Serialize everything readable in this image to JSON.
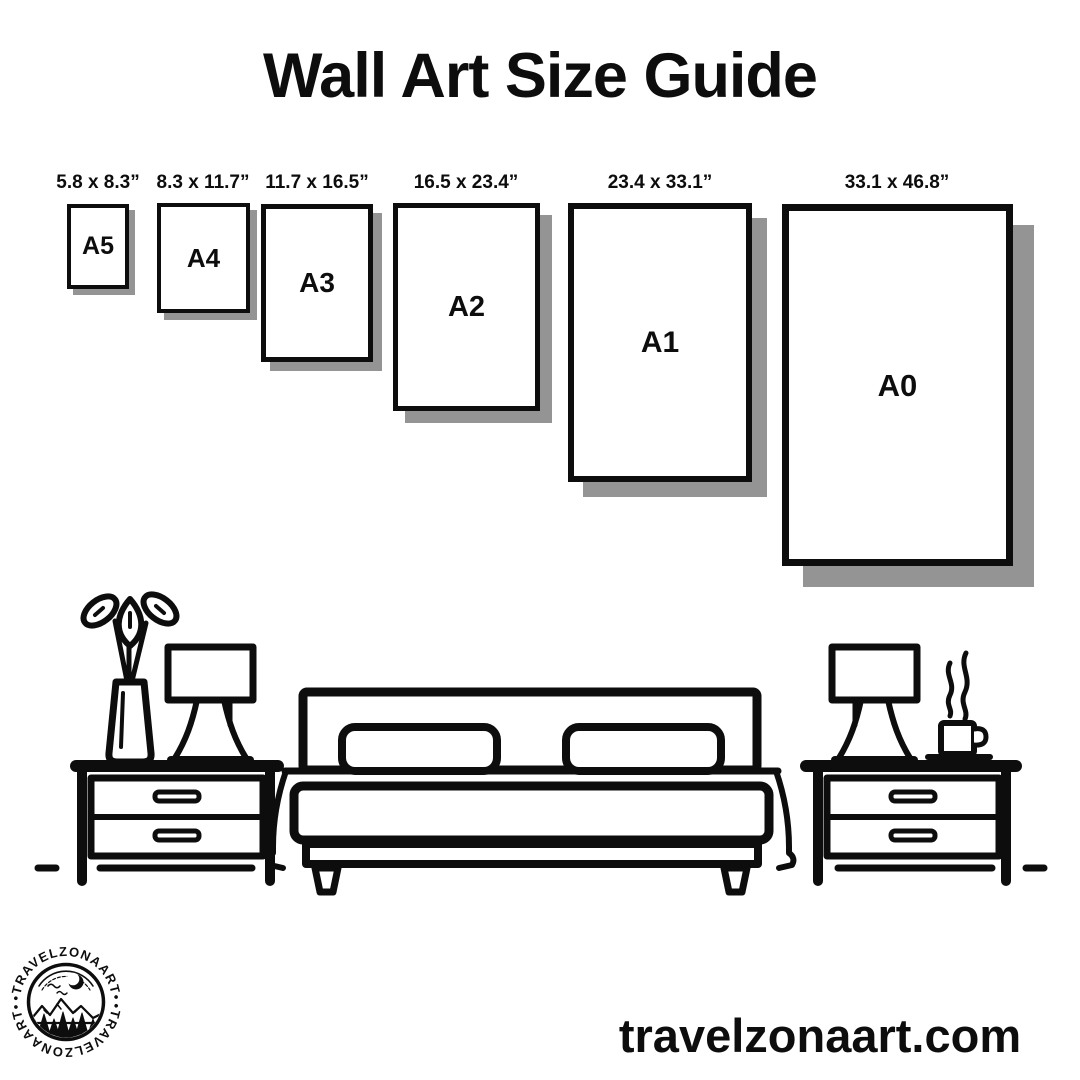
{
  "title": "Wall Art Size Guide",
  "sizes": [
    {
      "code": "A5",
      "dimensions": "5.8 x 8.3”"
    },
    {
      "code": "A4",
      "dimensions": "8.3 x 11.7”"
    },
    {
      "code": "A3",
      "dimensions": "11.7 x 16.5”"
    },
    {
      "code": "A2",
      "dimensions": "16.5 x 23.4”"
    },
    {
      "code": "A1",
      "dimensions": "23.4 x 33.1”"
    },
    {
      "code": "A0",
      "dimensions": "33.1 x 46.8”"
    }
  ],
  "illustration": {
    "icons": [
      "plant-vase-icon",
      "table-lamp-icon",
      "nightstand-icon",
      "double-bed-icon",
      "coffee-cup-icon"
    ]
  },
  "brand": {
    "logo_text_top": "•TRAVELZONAART•",
    "logo_text_bottom": "•TRAVELZONAART•",
    "website": "travelzonaart.com"
  },
  "colors": {
    "background": "#ffffff",
    "ink": "#0d0d0d",
    "shadow": "#949494"
  }
}
